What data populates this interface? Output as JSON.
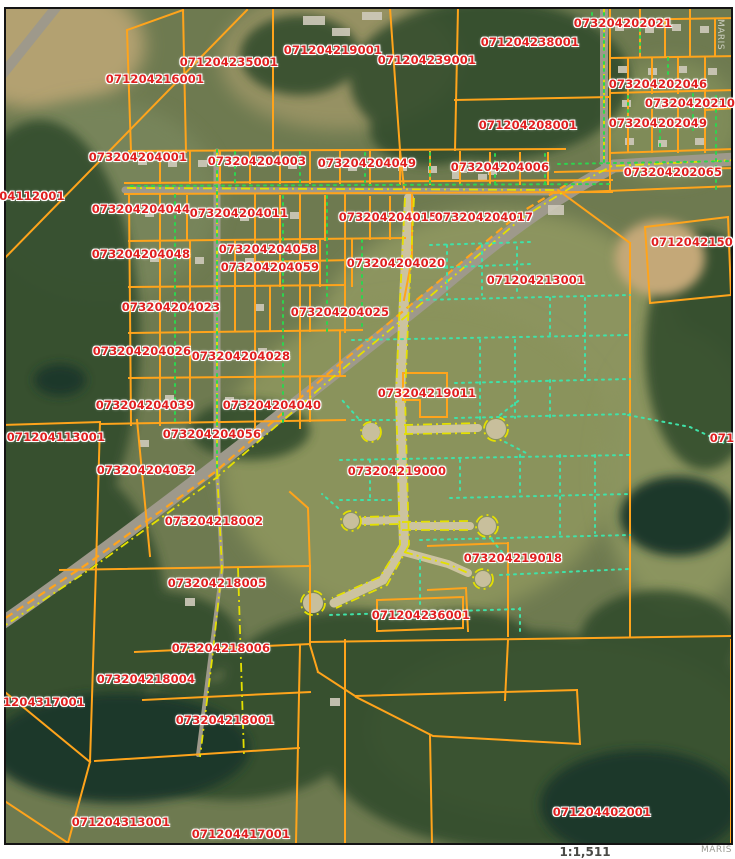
{
  "map": {
    "scale_label": "1:1,511",
    "watermark_bottom": "MARIS",
    "watermark_side": "MARIS",
    "colors": {
      "parcel_line": "#ffa41b",
      "parcel_label": "#e01f1f",
      "road_centerline": "#e4e000",
      "boundary_dots": "#2ed44e",
      "lot_line_dots": "#3fe2a8"
    },
    "parcels": [
      {
        "id": "071204216001",
        "x": 155,
        "y": 79
      },
      {
        "id": "071204235001",
        "x": 229,
        "y": 62
      },
      {
        "id": "071204219001",
        "x": 333,
        "y": 50
      },
      {
        "id": "071204239001",
        "x": 427,
        "y": 60
      },
      {
        "id": "071204238001",
        "x": 530,
        "y": 42
      },
      {
        "id": "073204202021",
        "x": 623,
        "y": 23
      },
      {
        "id": "073204202046",
        "x": 658,
        "y": 84
      },
      {
        "id": "07320420210",
        "x": 690,
        "y": 103
      },
      {
        "id": "073204202049",
        "x": 658,
        "y": 123
      },
      {
        "id": "071204208001",
        "x": 528,
        "y": 125
      },
      {
        "id": "073204204006",
        "x": 500,
        "y": 167
      },
      {
        "id": "073204202065",
        "x": 673,
        "y": 172
      },
      {
        "id": "073204204001",
        "x": 138,
        "y": 157
      },
      {
        "id": "073204204003",
        "x": 257,
        "y": 161
      },
      {
        "id": "073204204049",
        "x": 367,
        "y": 163
      },
      {
        "id": "073204204044",
        "x": 141,
        "y": 209
      },
      {
        "id": "073204204011",
        "x": 239,
        "y": 213
      },
      {
        "id": "073204204015",
        "x": 388,
        "y": 217
      },
      {
        "id": "073204204017",
        "x": 484,
        "y": 217
      },
      {
        "id": "0712042150",
        "x": 692,
        "y": 242
      },
      {
        "id": "073204204048",
        "x": 141,
        "y": 254
      },
      {
        "id": "073204204058",
        "x": 268,
        "y": 249
      },
      {
        "id": "073204204059",
        "x": 270,
        "y": 267
      },
      {
        "id": "073204204020",
        "x": 396,
        "y": 263
      },
      {
        "id": "071204213001",
        "x": 536,
        "y": 280
      },
      {
        "id": "073204204023",
        "x": 171,
        "y": 307
      },
      {
        "id": "073204204025",
        "x": 340,
        "y": 312
      },
      {
        "id": "073204204026",
        "x": 142,
        "y": 351
      },
      {
        "id": "073204204028",
        "x": 241,
        "y": 356
      },
      {
        "id": "073204219011",
        "x": 427,
        "y": 393
      },
      {
        "id": "073204204039",
        "x": 145,
        "y": 405
      },
      {
        "id": "073204204040",
        "x": 272,
        "y": 405
      },
      {
        "id": "04112001",
        "x": 32,
        "y": 196
      },
      {
        "id": "071204113001",
        "x": 56,
        "y": 437
      },
      {
        "id": "073204204056",
        "x": 212,
        "y": 434
      },
      {
        "id": "073204204032",
        "x": 146,
        "y": 470
      },
      {
        "id": "073204219000",
        "x": 397,
        "y": 471
      },
      {
        "id": "073204218002",
        "x": 214,
        "y": 521
      },
      {
        "id": "073204219018",
        "x": 513,
        "y": 558
      },
      {
        "id": "073204218005",
        "x": 217,
        "y": 583
      },
      {
        "id": "071204236001",
        "x": 421,
        "y": 615
      },
      {
        "id": "073204218006",
        "x": 221,
        "y": 648
      },
      {
        "id": "073204218004",
        "x": 146,
        "y": 679
      },
      {
        "id": "073204218001",
        "x": 225,
        "y": 720
      },
      {
        "id": "1204317001",
        "x": 44,
        "y": 702
      },
      {
        "id": "071204313001",
        "x": 121,
        "y": 822
      },
      {
        "id": "071204417001",
        "x": 241,
        "y": 834
      },
      {
        "id": "071204402001",
        "x": 602,
        "y": 812
      },
      {
        "id": "071",
        "x": 722,
        "y": 438
      }
    ]
  }
}
